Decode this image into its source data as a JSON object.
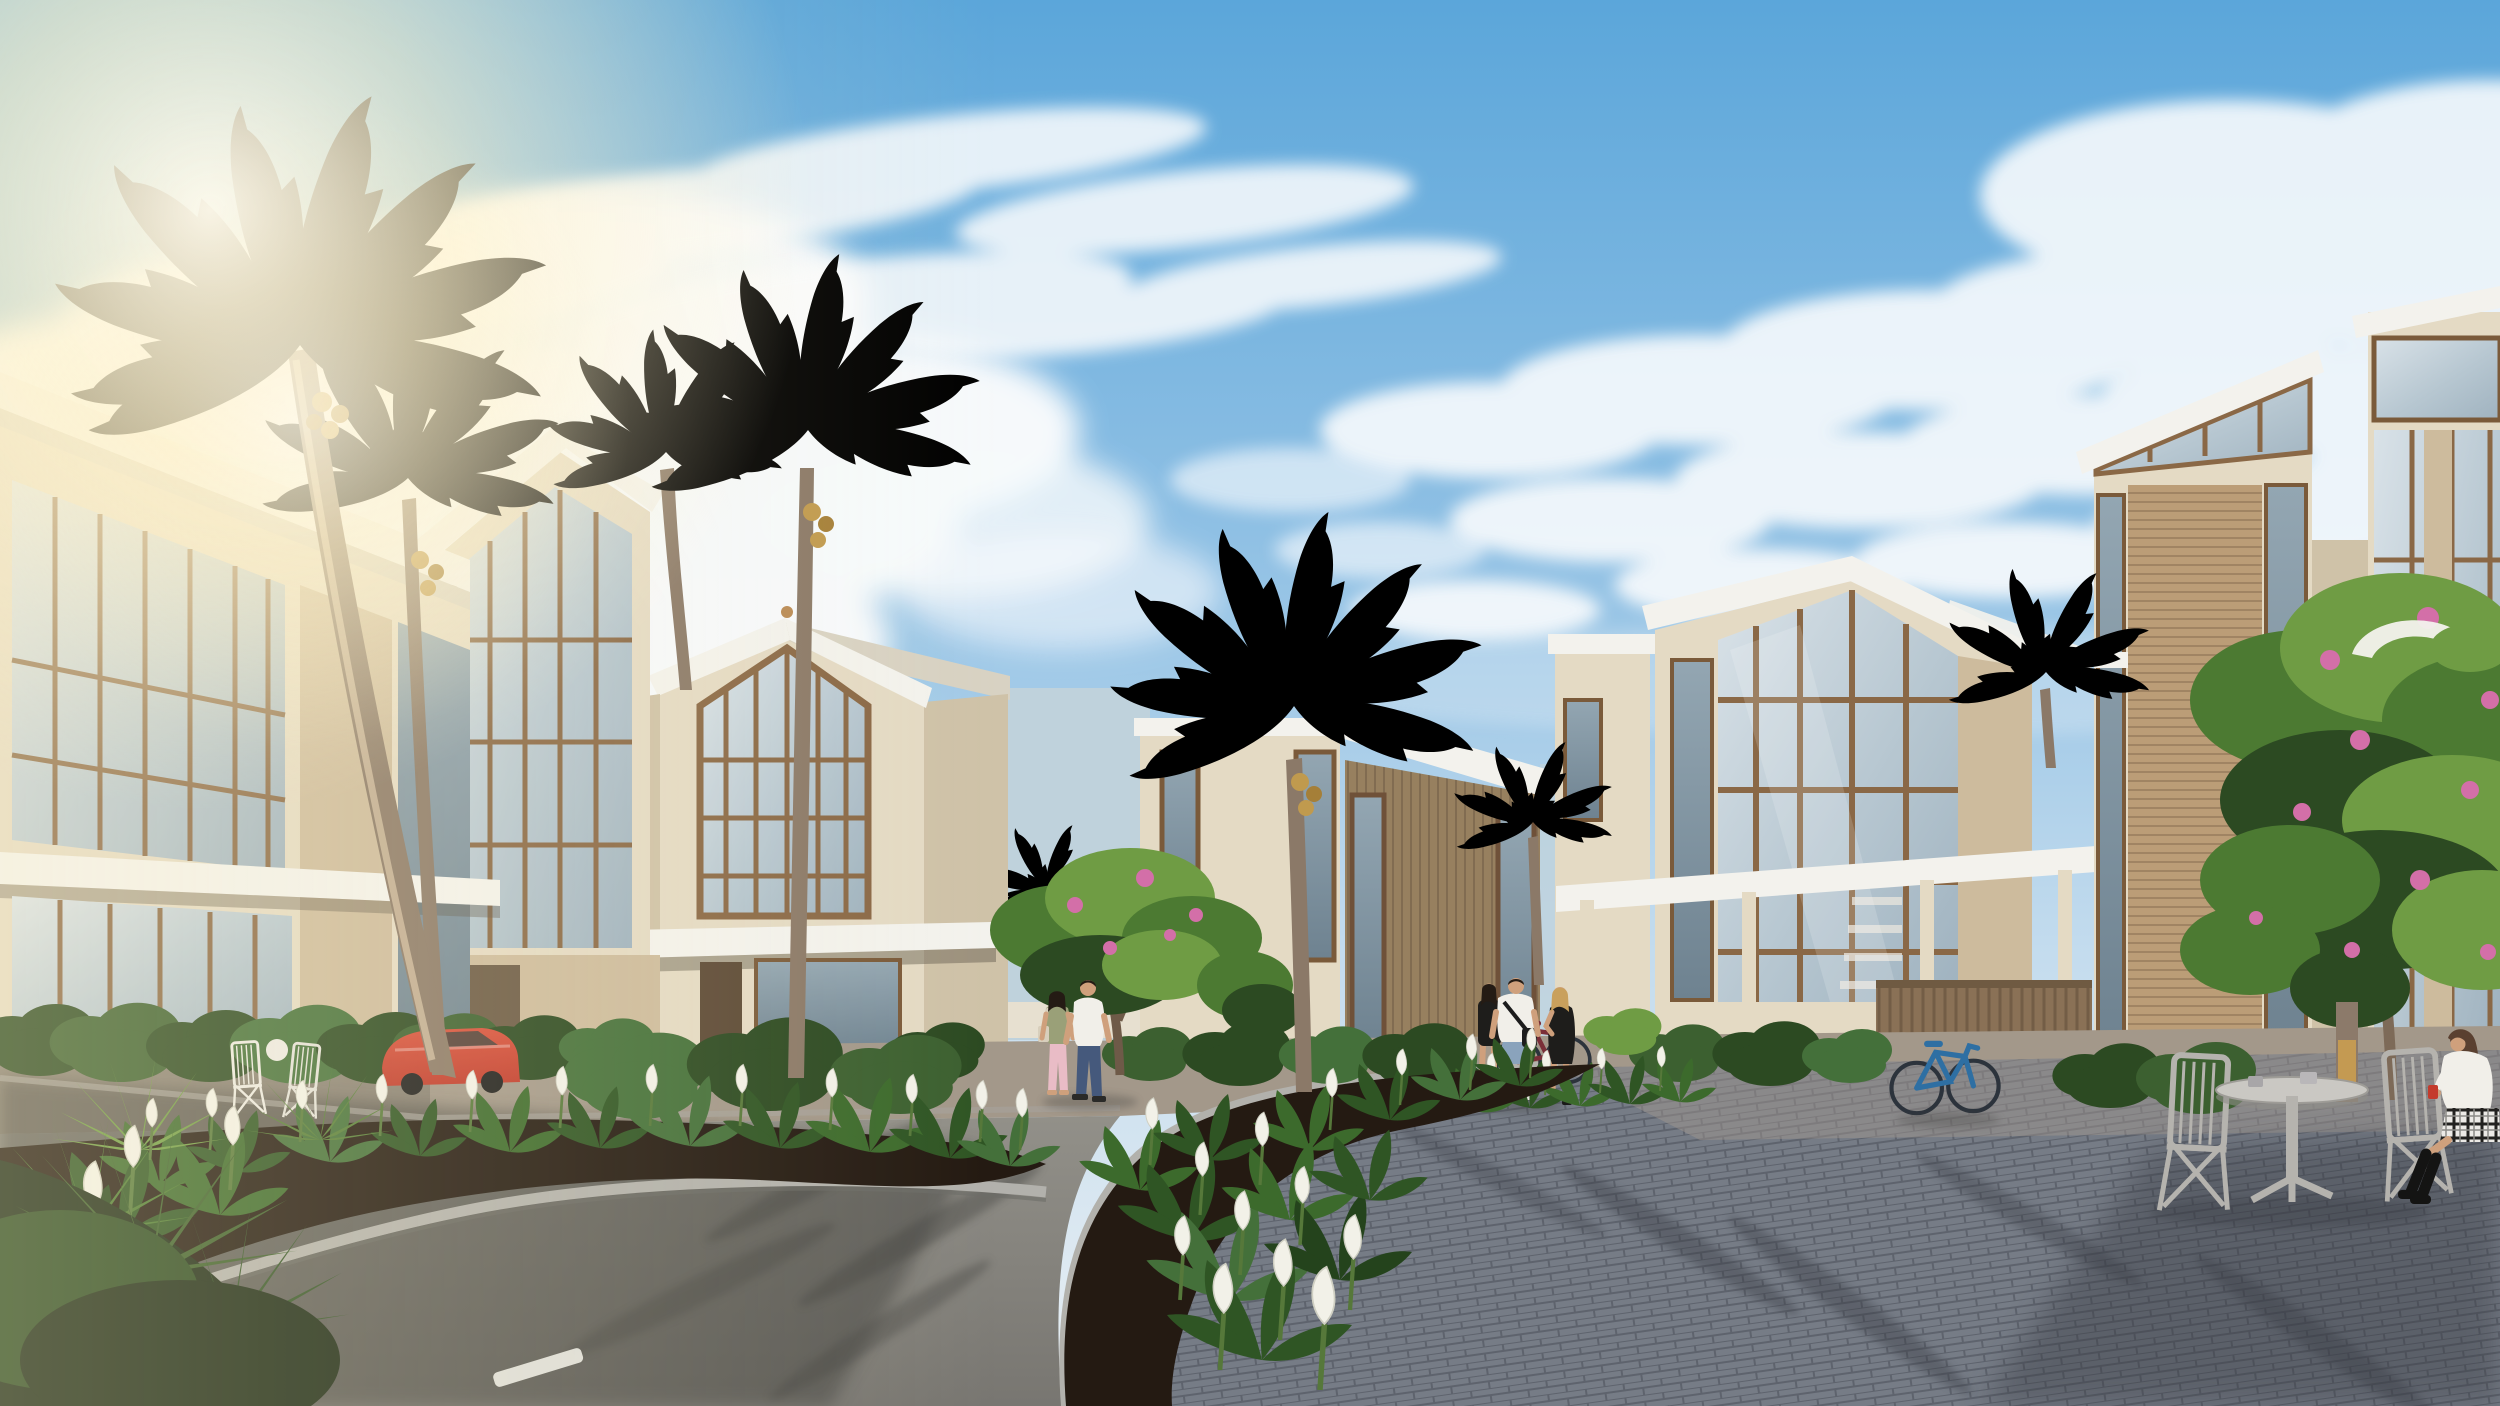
{
  "palette": {
    "sky_top": "#5ba6da",
    "sky_mid": "#8fc0e4",
    "sky_low": "#c4dcee",
    "sky_horizon": "#e9eff3",
    "cloud": "#fbfcfd",
    "sun": "#fff3cf",
    "cream": "#e4dac4",
    "cream_shade": "#cfc2a8",
    "stone": "#cdbb9d",
    "roof_white": "#f3f2ed",
    "roof_shade": "#d8d2c3",
    "mullion": "#8a6846",
    "glass": "#c4d1da",
    "glass_dark": "#9fb0bc",
    "wood": "#97805f",
    "wood_light": "#bb9d77",
    "wood_dark": "#6f5a44",
    "palm_green": "#7d9c4a",
    "palm_lit": "#c8cc66",
    "palm_dark": "#5f7c3a",
    "trunk": "#8b7968",
    "foliage": "#4c7a32",
    "foliage_dark": "#2c4a22",
    "pink": "#d36fa8",
    "soil": "#241a12",
    "lily_white": "#f2f1e8",
    "asphalt": "#8a8884",
    "asphalt_shadow": "#3f3f3d",
    "brick": "#767c86",
    "brick_dark": "#5e636d",
    "curb": "#b2b1ac",
    "pavement": "#a3988a",
    "pavement_lit": "#c2b19b",
    "grass": "#8fae3e",
    "car_red": "#c0392b",
    "bike_blue": "#2e6fa3",
    "bike_maroon": "#7a2f38",
    "skin": "#cfa07c",
    "denim": "#45597c",
    "denim_light": "#8aa3bc",
    "white_cloth": "#f1efe9",
    "black_cloth": "#1e1d1b",
    "pink_pants": "#e9bcc6",
    "olive": "#9aa078",
    "blonde": "#c9a05c",
    "hair_dark": "#241b14",
    "hair_brown": "#5a4030",
    "furniture": "#b5b3ae",
    "sea": "#bfd2dc"
  },
  "scene": {
    "description": "Photorealistic architectural rendering of a modern tropical beach-villa community on a sunny day; strong sunlight and lens glare from the upper left, blue sky with scattered clouds.",
    "sky": {
      "sun": "glare in upper-left corner",
      "clouds": "soft cumulus bank upper-left, thin diagonal streaks overhead, scattered puffs to the right"
    },
    "buildings": [
      {
        "name": "left-villa",
        "desc": "three-storey cream villa with full-height bronze-framed glazing, two white cantilevered slab roofs and a stone pier"
      },
      {
        "name": "second-villa",
        "desc": "villa with tilted white gable roof, brown-framed curtain wall, stone garden wall with timber gate"
      },
      {
        "name": "center-gable-villa",
        "desc": "symmetric gabled villa with triangular glazed attic, white entry canopy and dark timber door"
      },
      {
        "name": "timber-slat-villa",
        "desc": "mono-pitch white roof over a vertical timber-slat facade with tall corner windows; low cream annex beside it"
      },
      {
        "name": "glass-gable-villa",
        "desc": "large asymmetric gable glazed through two storeys (stair visible inside), white entry pergola, timber privacy fence"
      },
      {
        "name": "right-twin-towers",
        "desc": "two slant-roofed towers of cream stone, timber plank cladding and clerestory glazing, with a white parasol"
      }
    ],
    "vegetation": {
      "palms": "tall coconut palms: a large sun-lit palm at left, others at centre-left, centre and centre-right, small crowns between buildings",
      "flowering_trees": "frangipani trees with pink blossoms behind the walking couple and over the right cafe corner",
      "planters": "curved stone-curbed island beds dense with peace lilies (white spathes), yuccas and clipped shrubs"
    },
    "people": [
      {
        "name": "walking-couple",
        "desc": "man in white t-shirt and jeans, woman in olive tank top and pink leggings with a shoulder bag, strolling past the centre villa"
      },
      {
        "name": "standing-group",
        "desc": "man in white tee and denim shorts with black shoulder bag, woman in black beside him, blonde woman in a black dress on the phone, maroon bicycle parked behind"
      },
      {
        "name": "seated-woman",
        "desc": "long-haired woman in white blouse, black-and-white plaid skirt and black boots at the cafe table holding a red drink"
      }
    ],
    "vehicles": [
      {
        "name": "red-car",
        "desc": "red coupe parked beside the left villa"
      },
      {
        "name": "blue-bicycle",
        "desc": "blue bicycle leaning on the timber fence"
      },
      {
        "name": "maroon-bicycle",
        "desc": "maroon bicycle behind the standing group"
      }
    ],
    "street": {
      "surfaces": "dark asphalt loop road with short white dashed lane markings; blue-grey cobblestone plaza on the right; warm stone courtyard aprons by the villas",
      "details": "light stone curbs, long palm and building shadows across the paving"
    },
    "furniture": "grey folding cafe chairs and a round pedestal table with two cups on the plaza; white folding chairs on the left terrace"
  }
}
